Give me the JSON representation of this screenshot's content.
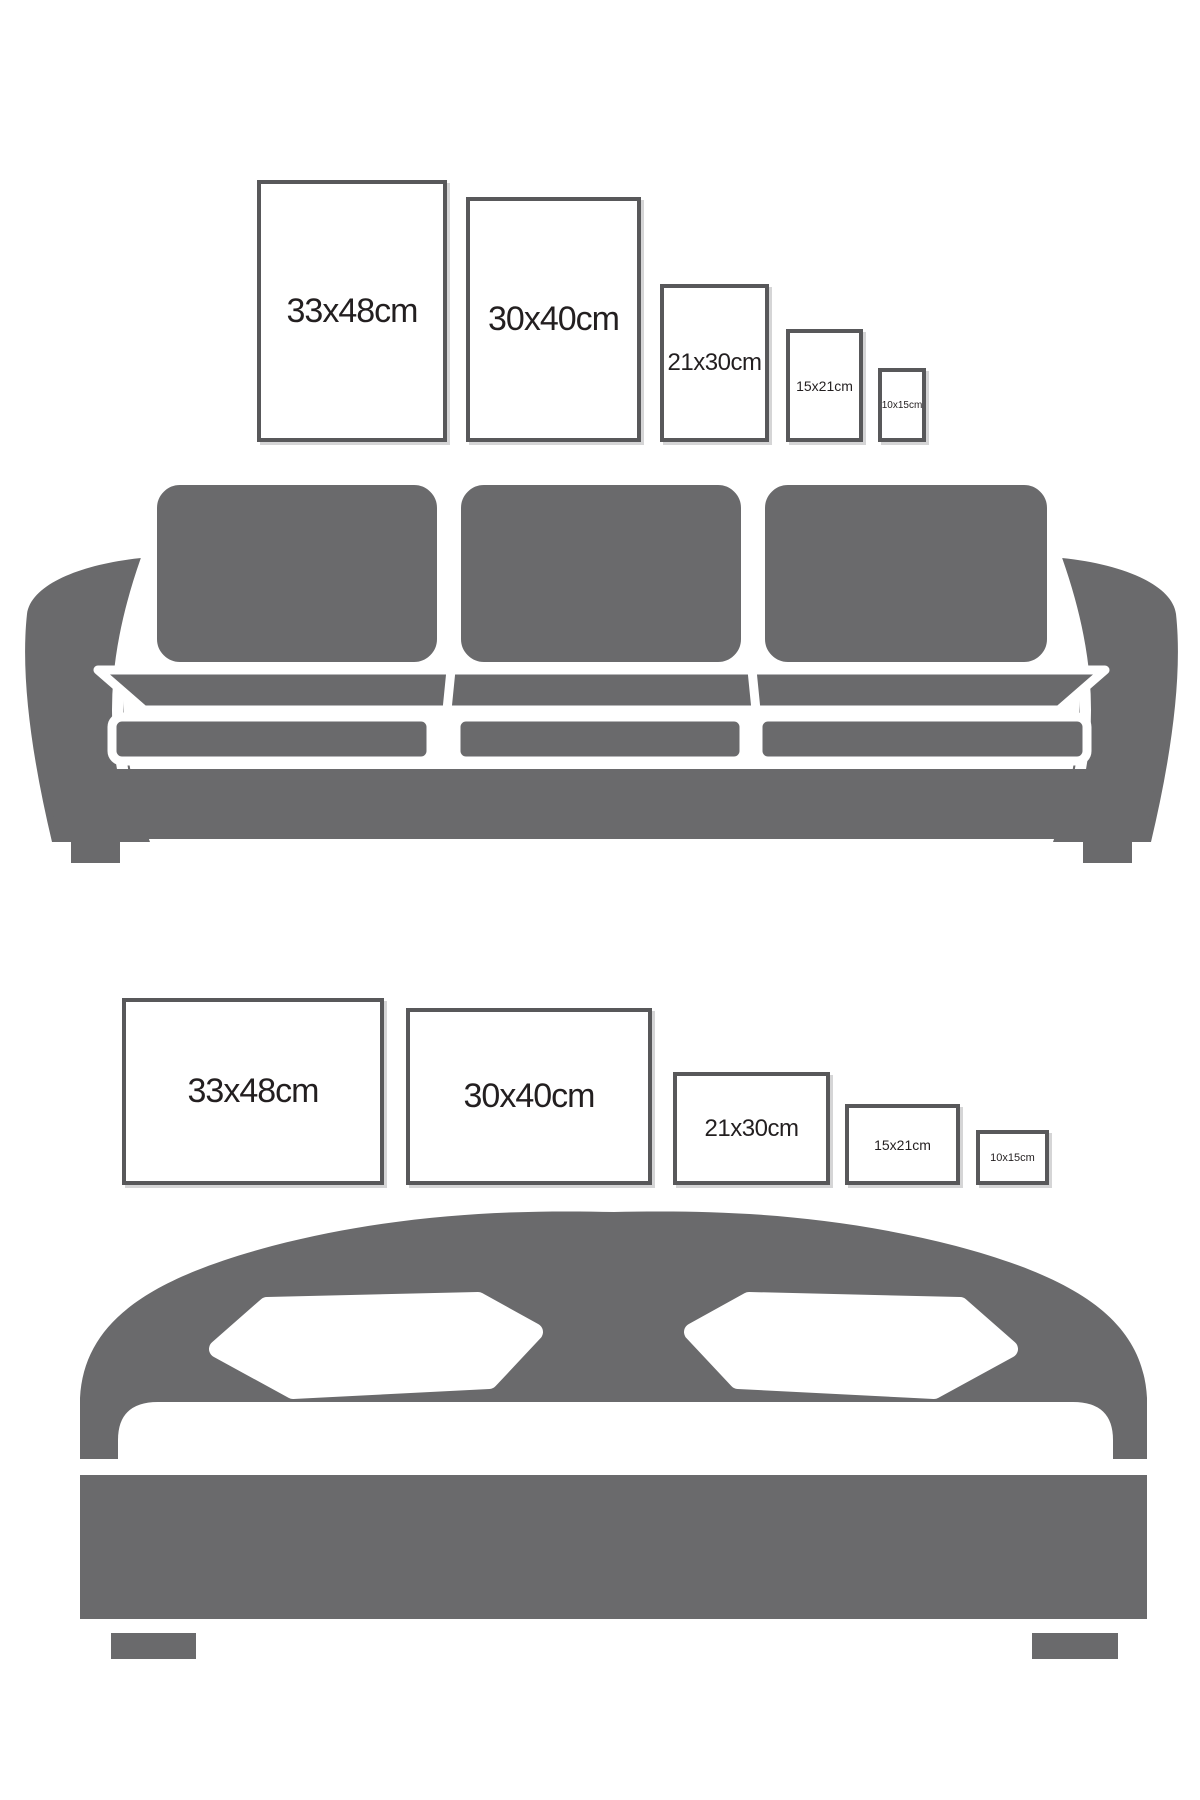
{
  "colors": {
    "furniture": "#6a6a6c",
    "frame_border": "#58585a",
    "text": "#231f20",
    "background": "#ffffff"
  },
  "sofa_section": {
    "frames": [
      {
        "label": "33x48cm",
        "orientation": "portrait"
      },
      {
        "label": "30x40cm",
        "orientation": "portrait"
      },
      {
        "label": "21x30cm",
        "orientation": "portrait"
      },
      {
        "label": "15x21cm",
        "orientation": "portrait"
      },
      {
        "label": "10x15cm",
        "orientation": "portrait"
      }
    ]
  },
  "bed_section": {
    "frames": [
      {
        "label": "33x48cm",
        "orientation": "landscape"
      },
      {
        "label": "30x40cm",
        "orientation": "landscape"
      },
      {
        "label": "21x30cm",
        "orientation": "landscape"
      },
      {
        "label": "15x21cm",
        "orientation": "landscape"
      },
      {
        "label": "10x15cm",
        "orientation": "landscape"
      }
    ]
  }
}
